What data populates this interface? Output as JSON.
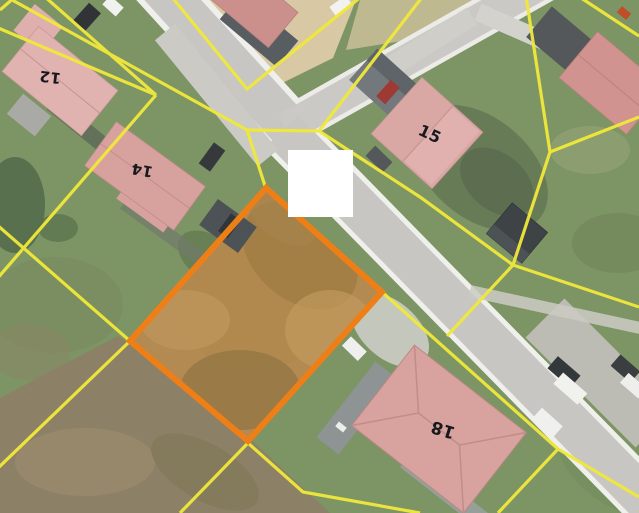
{
  "map": {
    "house_labels": [
      {
        "name": "house-12",
        "text": "12"
      },
      {
        "name": "house-14",
        "text": "14"
      },
      {
        "name": "house-15",
        "text": "15"
      },
      {
        "name": "house-18",
        "text": "18"
      }
    ],
    "colors": {
      "parcel_boundary_yellow": "#f1e93a",
      "highlighted_parcel_orange": "#ee7f17",
      "censor_block_white": "#ffffff",
      "road_gray": "#c7c6c2",
      "grass_green": "#7d9465",
      "bare_soil_tan": "#b28a52",
      "roof_pink": "#d6a09d"
    }
  }
}
